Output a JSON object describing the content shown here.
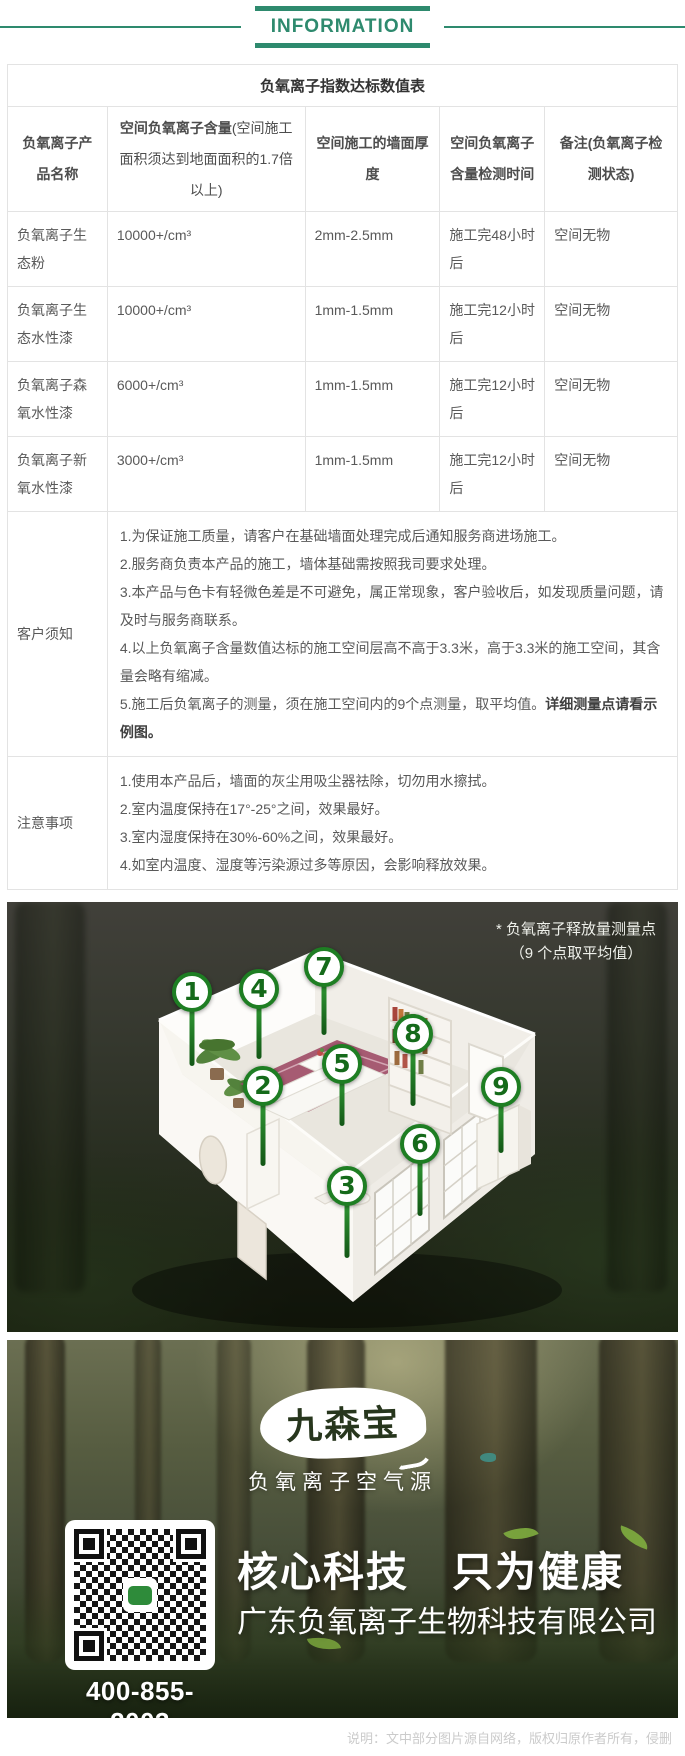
{
  "theme": {
    "accent_green": "#2e8a6e",
    "marker_green": "#1e7e23"
  },
  "header": {
    "title": "INFORMATION"
  },
  "table": {
    "title": "负氧离子指数达标数值表",
    "columns": [
      {
        "label": "负氧离子产品名称"
      },
      {
        "label": "空间负氧离子含量",
        "sub": "(空间施工面积须达到地面面积的1.7倍以上)"
      },
      {
        "label": "空间施工的墙面厚度"
      },
      {
        "label": "空间负氧离子含量检测时间"
      },
      {
        "label": "备注(负氧离子检测状态)"
      }
    ],
    "rows": [
      {
        "product": "负氧离子生态粉",
        "content": "10000+/cm³",
        "thickness": "2mm-2.5mm",
        "test_time": "施工完48小时后",
        "note": "空间无物"
      },
      {
        "product": "负氧离子生态水性漆",
        "content": "10000+/cm³",
        "thickness": "1mm-1.5mm",
        "test_time": "施工完12小时后",
        "note": "空间无物"
      },
      {
        "product": "负氧离子森氧水性漆",
        "content": "6000+/cm³",
        "thickness": "1mm-1.5mm",
        "test_time": "施工完12小时后",
        "note": "空间无物"
      },
      {
        "product": "负氧离子新氧水性漆",
        "content": "3000+/cm³",
        "thickness": "1mm-1.5mm",
        "test_time": "施工完12小时后",
        "note": "空间无物"
      }
    ],
    "customer_notice": {
      "label": "客户须知",
      "items": [
        "1.为保证施工质量，请客户在基础墙面处理完成后通知服务商进场施工。",
        "2.服务商负责本产品的施工，墙体基础需按照我司要求处理。",
        "3.本产品与色卡有轻微色差是不可避免，属正常现象，客户验收后，如发现质量问题，请及时与服务商联系。",
        "4.以上负氧离子含量数值达标的施工空间层高不高于3.3米，高于3.3米的施工空间，其含量会略有缩减。"
      ],
      "item5_text": "5.施工后负氧离子的测量，须在施工空间内的9个点测量，取平均值。",
      "item5_bold": "详细测量点请看示例图。"
    },
    "attention": {
      "label": "注意事项",
      "items": [
        "1.使用本产品后，墙面的灰尘用吸尘器祛除，切勿用水擦拭。",
        "2.室内温度保持在17°-25°之间，效果最好。",
        "3.室内湿度保持在30%-60%之间，效果最好。",
        "4.如室内温度、湿度等污染源过多等原因，会影响释放效果。"
      ]
    }
  },
  "room_figure": {
    "note_line1": "* 负氧离子释放量测量点",
    "note_line2": "（9 个点取平均值）",
    "markers": [
      {
        "label": "1"
      },
      {
        "label": "2"
      },
      {
        "label": "3"
      },
      {
        "label": "4"
      },
      {
        "label": "5"
      },
      {
        "label": "6"
      },
      {
        "label": "7"
      },
      {
        "label": "8"
      },
      {
        "label": "9"
      }
    ]
  },
  "footer": {
    "brand": "九森宝",
    "tagline": "负氧离子空气源",
    "slogan": "核心科技　只为健康",
    "company": "广东负氧离子生物科技有限公司",
    "phone": "400-855-2003"
  },
  "page_note": "说明：文中部分图片源自网络，版权归原作者所有，侵删"
}
